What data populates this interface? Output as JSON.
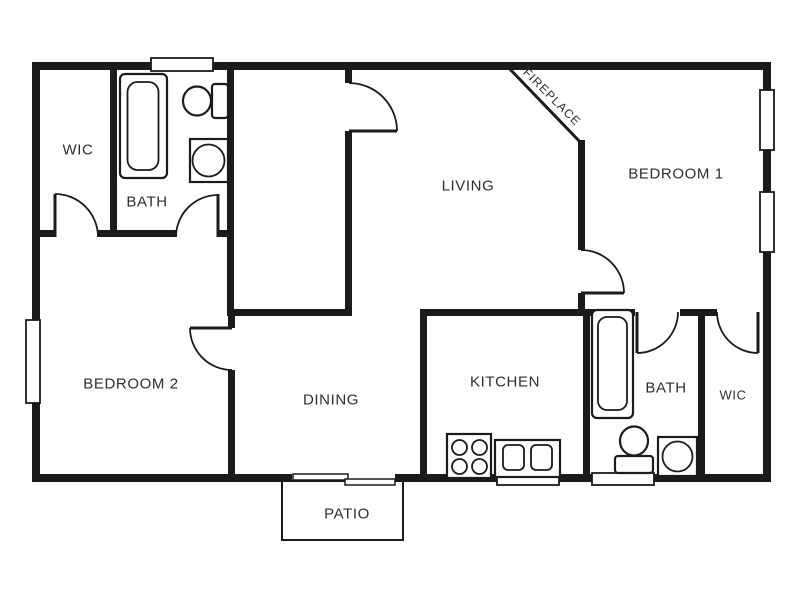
{
  "floorplan": {
    "type": "apartment-floor-plan",
    "colors": {
      "wall": "#1b1b1b",
      "background": "#ffffff",
      "text": "#2e2e2e"
    },
    "labels": {
      "wic_upper": "WIC",
      "bath_upper": "BATH",
      "living": "LIVING",
      "fireplace": "FIREPLACE",
      "bedroom1": "BEDROOM 1",
      "bedroom2": "BEDROOM 2",
      "dining": "DINING",
      "kitchen": "KITCHEN",
      "bath_lower": "BATH",
      "wic_lower": "WIC",
      "patio": "PATIO"
    },
    "fixtures": [
      "bathtub",
      "toilet",
      "vanity-sink",
      "stove-burners",
      "double-kitchen-sink",
      "window",
      "hinged-door",
      "sliding-patio-door",
      "fireplace-diagonal-wall"
    ]
  }
}
